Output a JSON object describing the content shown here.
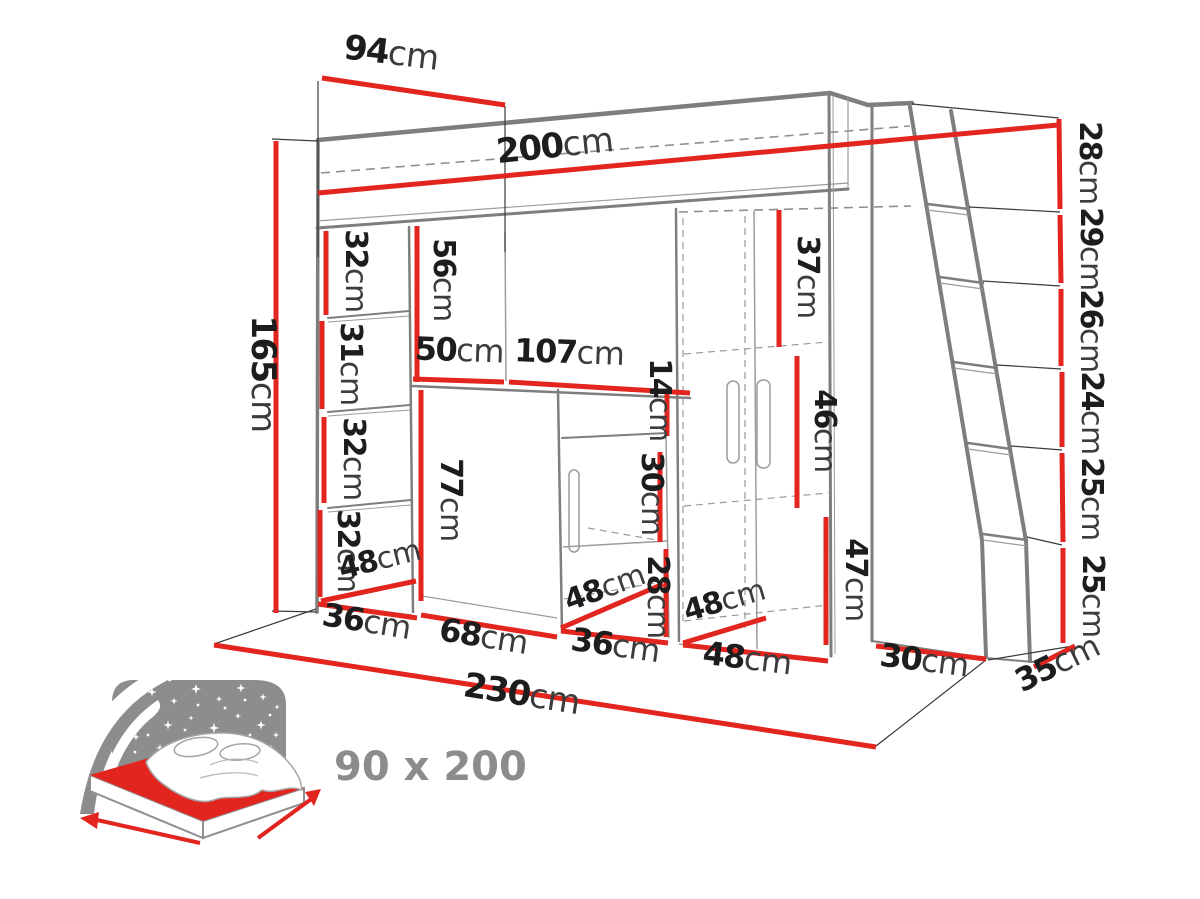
{
  "colors": {
    "accent_red": "#e2251f",
    "line_gray": "#7e7e7e",
    "text_dark": "#1d1d1d",
    "unit_gray": "#3c3c3c",
    "icon_gray": "#8d8d8d"
  },
  "dimensions": {
    "top_depth": {
      "num": "94",
      "unit": "cm"
    },
    "bed_length": {
      "num": "200",
      "unit": "cm"
    },
    "ladder_steps": [
      {
        "num": "28",
        "unit": "cm"
      },
      {
        "num": "29",
        "unit": "cm"
      },
      {
        "num": "26",
        "unit": "cm"
      },
      {
        "num": "24",
        "unit": "cm"
      },
      {
        "num": "25",
        "unit": "cm"
      },
      {
        "num": "25",
        "unit": "cm"
      }
    ],
    "total_height": {
      "num": "165",
      "unit": "cm"
    },
    "left_shelves": [
      {
        "num": "32",
        "unit": "cm"
      },
      {
        "num": "31",
        "unit": "cm"
      },
      {
        "num": "32",
        "unit": "cm"
      },
      {
        "num": "32",
        "unit": "cm"
      }
    ],
    "hutch_height": {
      "num": "56",
      "unit": "cm"
    },
    "hutch_left_width": {
      "num": "50",
      "unit": "cm"
    },
    "desk_top_width": {
      "num": "107",
      "unit": "cm"
    },
    "desk_height": {
      "num": "77",
      "unit": "cm"
    },
    "hutch_gap": {
      "num": "14",
      "unit": "cm"
    },
    "side_cabinet_upper": {
      "num": "30",
      "unit": "cm"
    },
    "side_cabinet_lower": {
      "num": "28",
      "unit": "cm"
    },
    "wardrobe_top_shelf": {
      "num": "37",
      "unit": "cm"
    },
    "wardrobe_middle": {
      "num": "46",
      "unit": "cm"
    },
    "wardrobe_bottom": {
      "num": "47",
      "unit": "cm"
    },
    "left_column_depth": {
      "num": "48",
      "unit": "cm"
    },
    "left_column_width": {
      "num": "36",
      "unit": "cm"
    },
    "desk_width": {
      "num": "68",
      "unit": "cm"
    },
    "side_cabinet_depth": {
      "num": "48",
      "unit": "cm"
    },
    "side_cabinet_width": {
      "num": "36",
      "unit": "cm"
    },
    "wardrobe_depth": {
      "num": "48",
      "unit": "cm"
    },
    "wardrobe_width": {
      "num": "48",
      "unit": "cm"
    },
    "end_panel_width": {
      "num": "30",
      "unit": "cm"
    },
    "side_depth": {
      "num": "35",
      "unit": "cm"
    },
    "total_width": {
      "num": "230",
      "unit": "cm"
    }
  },
  "bed_icon": {
    "size_label": "90 x 200"
  }
}
